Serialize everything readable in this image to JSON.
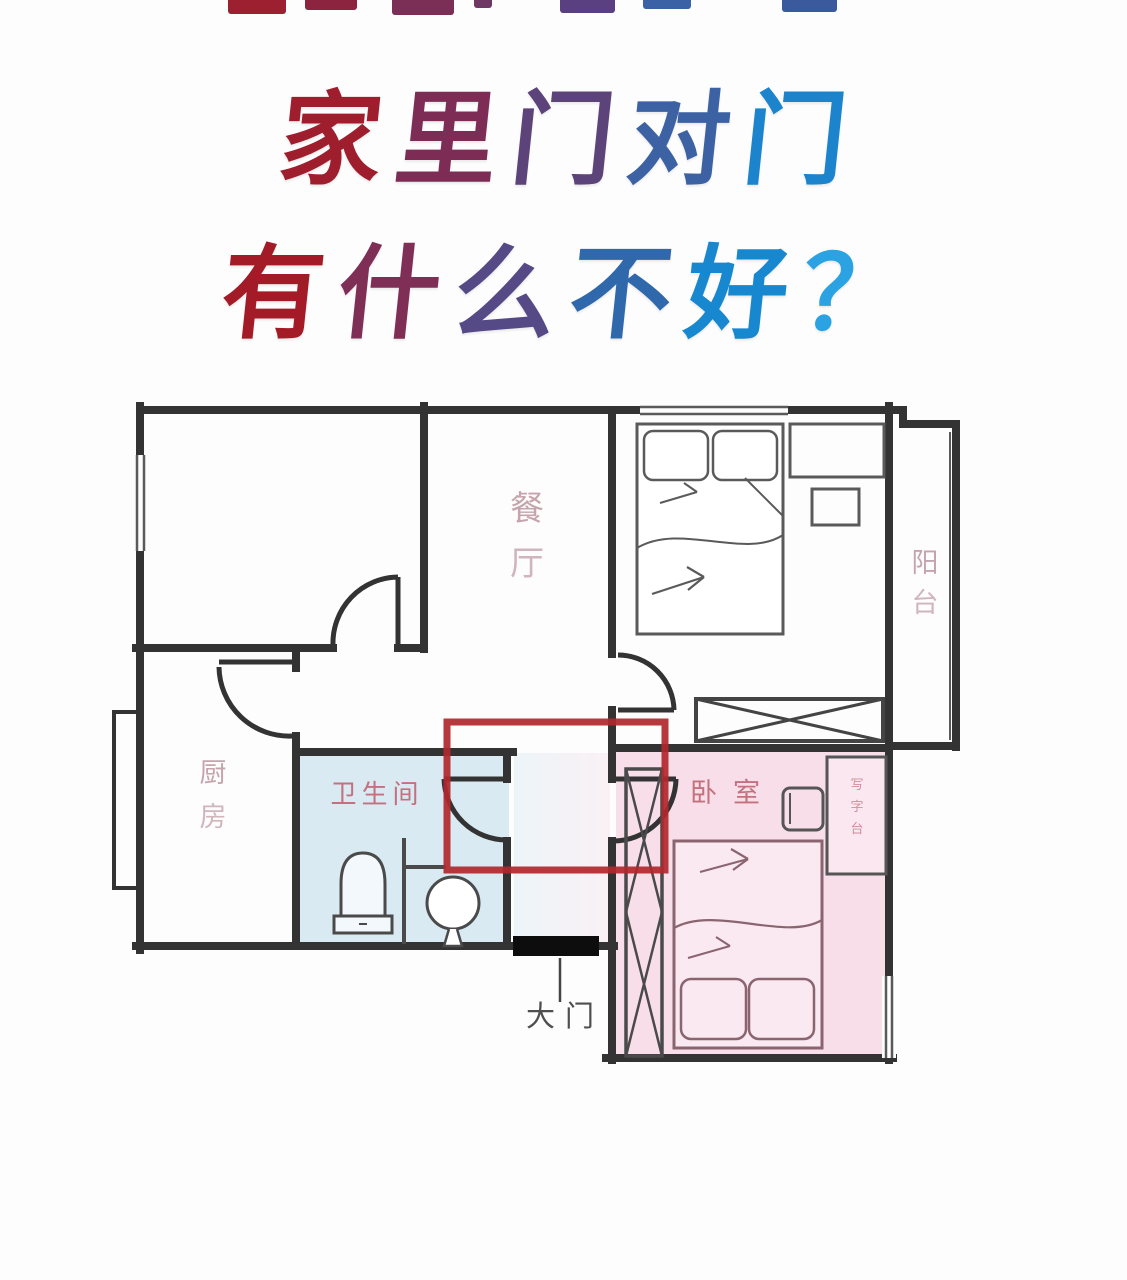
{
  "title": {
    "line1": [
      {
        "ch": "家",
        "color": "#9e1e2e"
      },
      {
        "ch": "里",
        "color": "#7d2d55"
      },
      {
        "ch": "门",
        "color": "#5c4379"
      },
      {
        "ch": "对",
        "color": "#3d62a4"
      },
      {
        "ch": "门",
        "color": "#1b84cd"
      }
    ],
    "line2": [
      {
        "ch": "有",
        "color": "#a31b26"
      },
      {
        "ch": "什",
        "color": "#7f2f56"
      },
      {
        "ch": "么",
        "color": "#564a86"
      },
      {
        "ch": "不",
        "color": "#2f68ab"
      },
      {
        "ch": "好",
        "color": "#1787cf"
      },
      {
        "ch": "？",
        "color": "#2ba3e3"
      }
    ]
  },
  "floorplan": {
    "labels": {
      "dining": "餐厅",
      "kitchen": "厨房",
      "bathroom": "卫生间",
      "bedroom": "卧室",
      "balcony": "阳台",
      "desk": "写字台",
      "main_door": "大门"
    },
    "colors": {
      "wall": "#333333",
      "bathroom_fill": "#d9eaf2",
      "bedroom_fill": "#f8dee9",
      "bed_fill": "#fbe9f1",
      "desk_fill": "#fae7f0",
      "highlight_box": "#b1272c",
      "label_muted": "#b98f9b",
      "label_pink": "#c4717f",
      "door_label": "#4f4f4f",
      "threshold": "#0d0d0d"
    }
  }
}
